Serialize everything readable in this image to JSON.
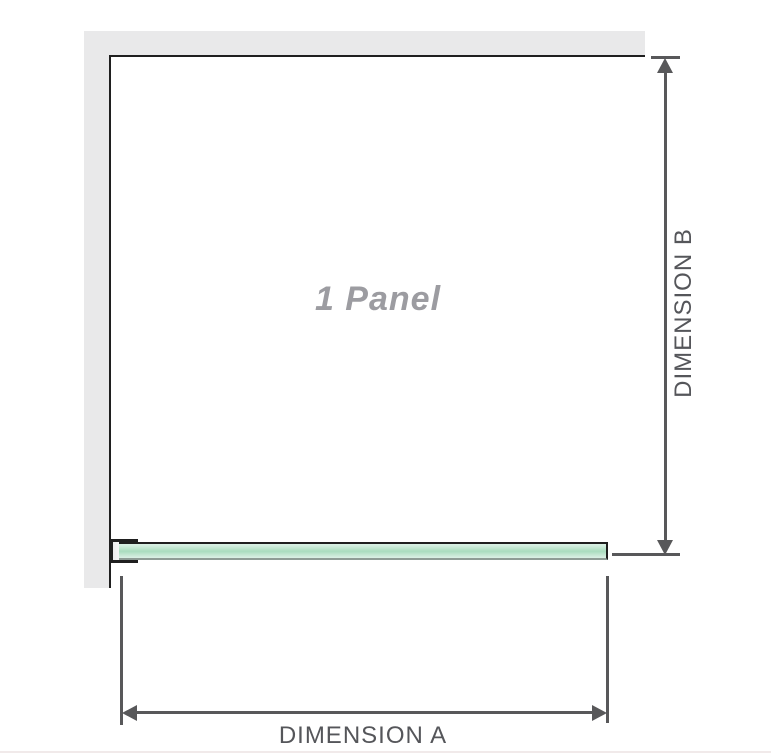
{
  "diagram": {
    "title": "1 panel shower screen dimension diagram",
    "panel_label": "1 Panel",
    "dimension_a_label": "DIMENSION A",
    "dimension_b_label": "DIMENSION B"
  },
  "colors": {
    "wall": "#e9e9ea",
    "outline": "#1f1f1f",
    "glass_mid": "#a9dcbe",
    "glass_light": "#d7efe2",
    "glass_border_bottom": "#8e9c95",
    "dim": "#58585a",
    "label": "#55565a",
    "panel_label": "#9c9ca1",
    "divider": "#f1eaea"
  }
}
